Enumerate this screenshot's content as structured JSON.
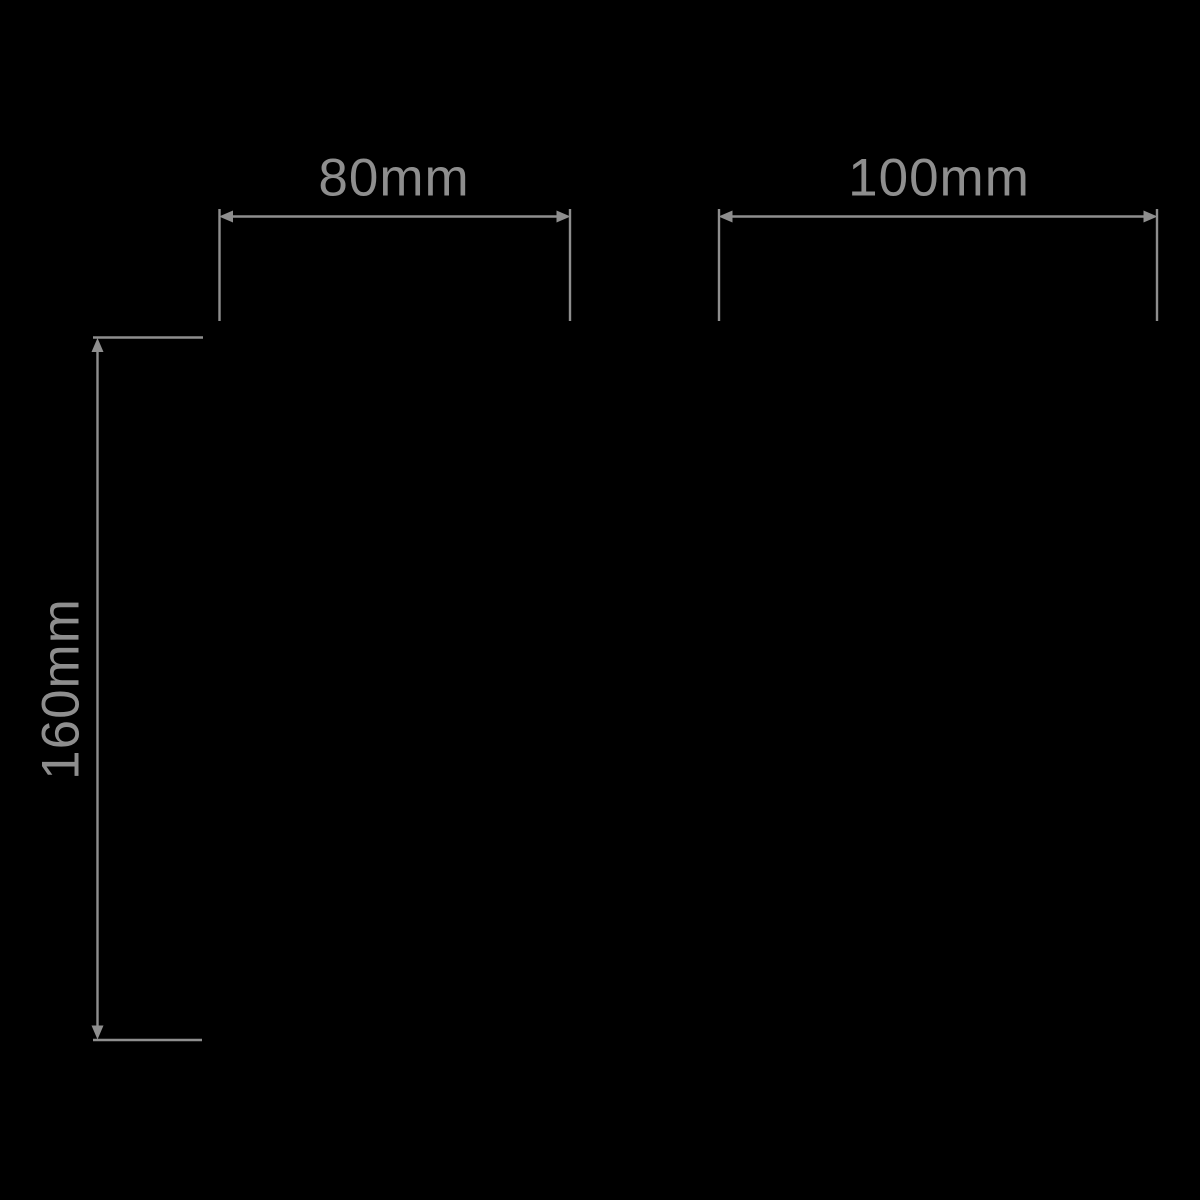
{
  "colors": {
    "background": "#000000",
    "line": "#8e8e8e",
    "text": "#8e8e8e"
  },
  "dimensions": {
    "top_left_width": {
      "label": "80mm",
      "value_mm": 80,
      "orientation": "horizontal"
    },
    "top_right_width": {
      "label": "100mm",
      "value_mm": 100,
      "orientation": "horizontal"
    },
    "left_height": {
      "label": "160mm",
      "value_mm": 160,
      "orientation": "vertical"
    }
  }
}
